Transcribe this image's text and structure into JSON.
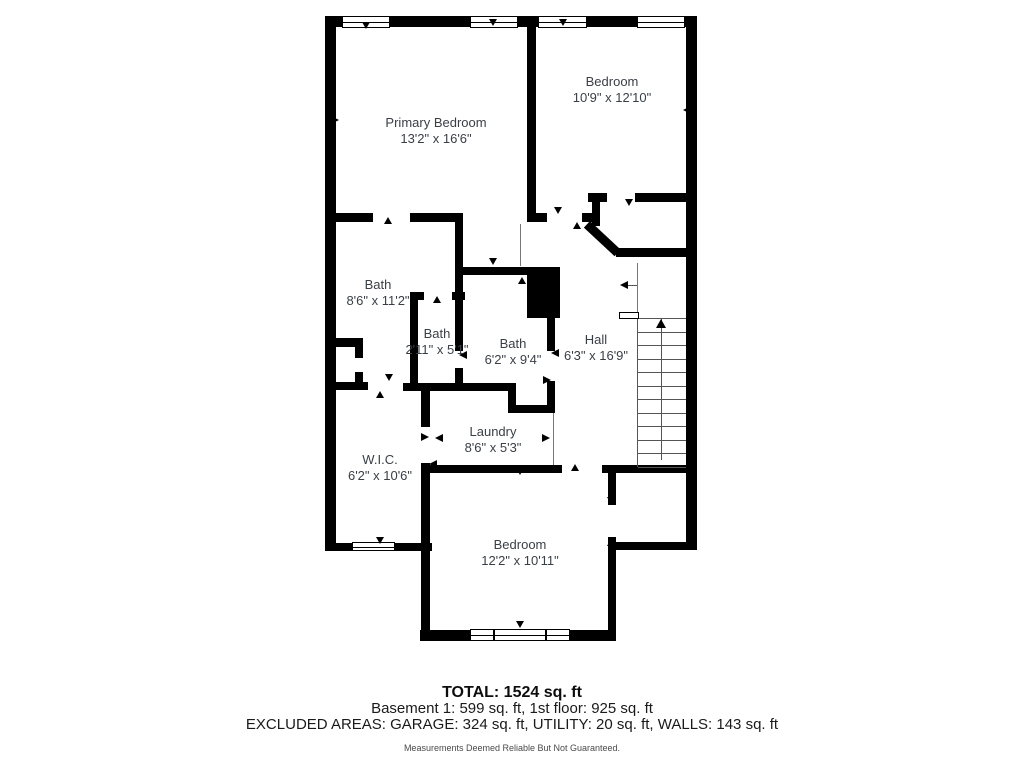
{
  "plan_title": "Floor plan",
  "rooms": [
    {
      "key": "primary-bedroom",
      "name": "Primary Bedroom",
      "dims": "13'2\" x 16'6\""
    },
    {
      "key": "bedroom-top",
      "name": "Bedroom",
      "dims": "10'9\" x 12'10\""
    },
    {
      "key": "bath-main",
      "name": "Bath",
      "dims": "8'6\" x 11'2\""
    },
    {
      "key": "bath-small",
      "name": "Bath",
      "dims": "2'11\" x 5'1\""
    },
    {
      "key": "bath-mid",
      "name": "Bath",
      "dims": "6'2\" x 9'4\""
    },
    {
      "key": "hall",
      "name": "Hall",
      "dims": "6'3\" x 16'9\""
    },
    {
      "key": "laundry",
      "name": "Laundry",
      "dims": "8'6\" x 5'3\""
    },
    {
      "key": "wic",
      "name": "W.I.C.",
      "dims": "6'2\" x 10'6\""
    },
    {
      "key": "bedroom-bottom",
      "name": "Bedroom",
      "dims": "12'2\" x 10'11\""
    }
  ],
  "summary": {
    "total": "TOTAL: 1524 sq. ft",
    "floors": "Basement 1: 599 sq. ft, 1st floor: 925 sq. ft",
    "excluded": "EXCLUDED AREAS: GARAGE: 324 sq. ft, UTILITY: 20 sq. ft, WALLS: 143 sq. ft",
    "disclaimer": "Measurements Deemed Reliable But Not Guaranteed."
  },
  "colors": {
    "wall": "#000000",
    "label_text": "#3a3f46"
  }
}
